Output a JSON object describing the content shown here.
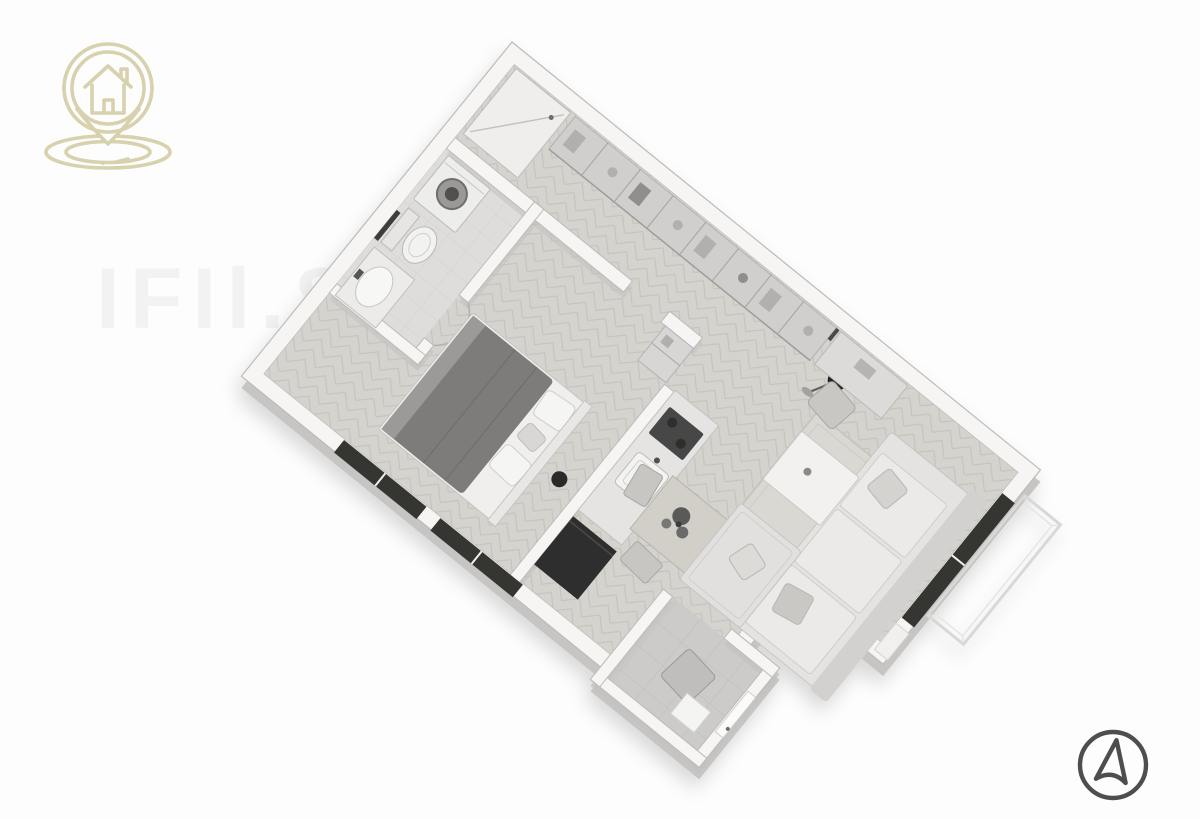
{
  "image": {
    "kind": "3d-isometric-floor-plan-render",
    "background": "#fdfdfd",
    "style": "grayscale architectural visualization, studio apartment viewed from above at an angle"
  },
  "branding": {
    "logo_icon": "house-location-pin-icon",
    "logo_color": "#d7d1ad",
    "logo_position": "top-left"
  },
  "compass": {
    "icon": "north-arrow-icon",
    "color": "#4e4e4e",
    "position": "bottom-right"
  },
  "watermark": {
    "text": "IFIl.S",
    "opacity": "0.09"
  },
  "palette": {
    "bg": "#fdfdfd",
    "wall-top": "#f6f5f4",
    "wall-side": "#c6c5c3",
    "wall-stroke": "#bcbbb9",
    "parquet-base": "#d5d3ce",
    "parquet-line": "#c5c2bc",
    "bath-tile": "#dedddb",
    "bath-grid": "#d2d1cf",
    "hall-tile": "#cccbca",
    "hall-grid": "#bdbcbb",
    "dark": "#343433",
    "furn-dark": "#7d7c7a",
    "rug": "#dad8d3",
    "logo": "#d7d1ad",
    "compass": "#4e4e4e",
    "watermark": "#8f8f8f"
  },
  "floor_plan": {
    "rooms": [
      "entry-closet",
      "hallway-with-wardrobes",
      "bathroom",
      "bedroom",
      "kitchen",
      "living-dining-area",
      "entrance-vestibule",
      "terrace-outline"
    ],
    "furnishings": [
      "washing-machine",
      "toilet",
      "bathroom-sink",
      "double-bed",
      "wardrobe-row",
      "kitchen-counter-with-sink-and-cooktop",
      "kitchen-tall-unit",
      "dining-table-with-plant",
      "dining-chairs",
      "rug",
      "l-shaped-sofa-with-pillows",
      "coffee-table",
      "floor-lamp",
      "desk",
      "desk-chair",
      "hall-chair",
      "door-mat",
      "front-door",
      "windows"
    ]
  }
}
